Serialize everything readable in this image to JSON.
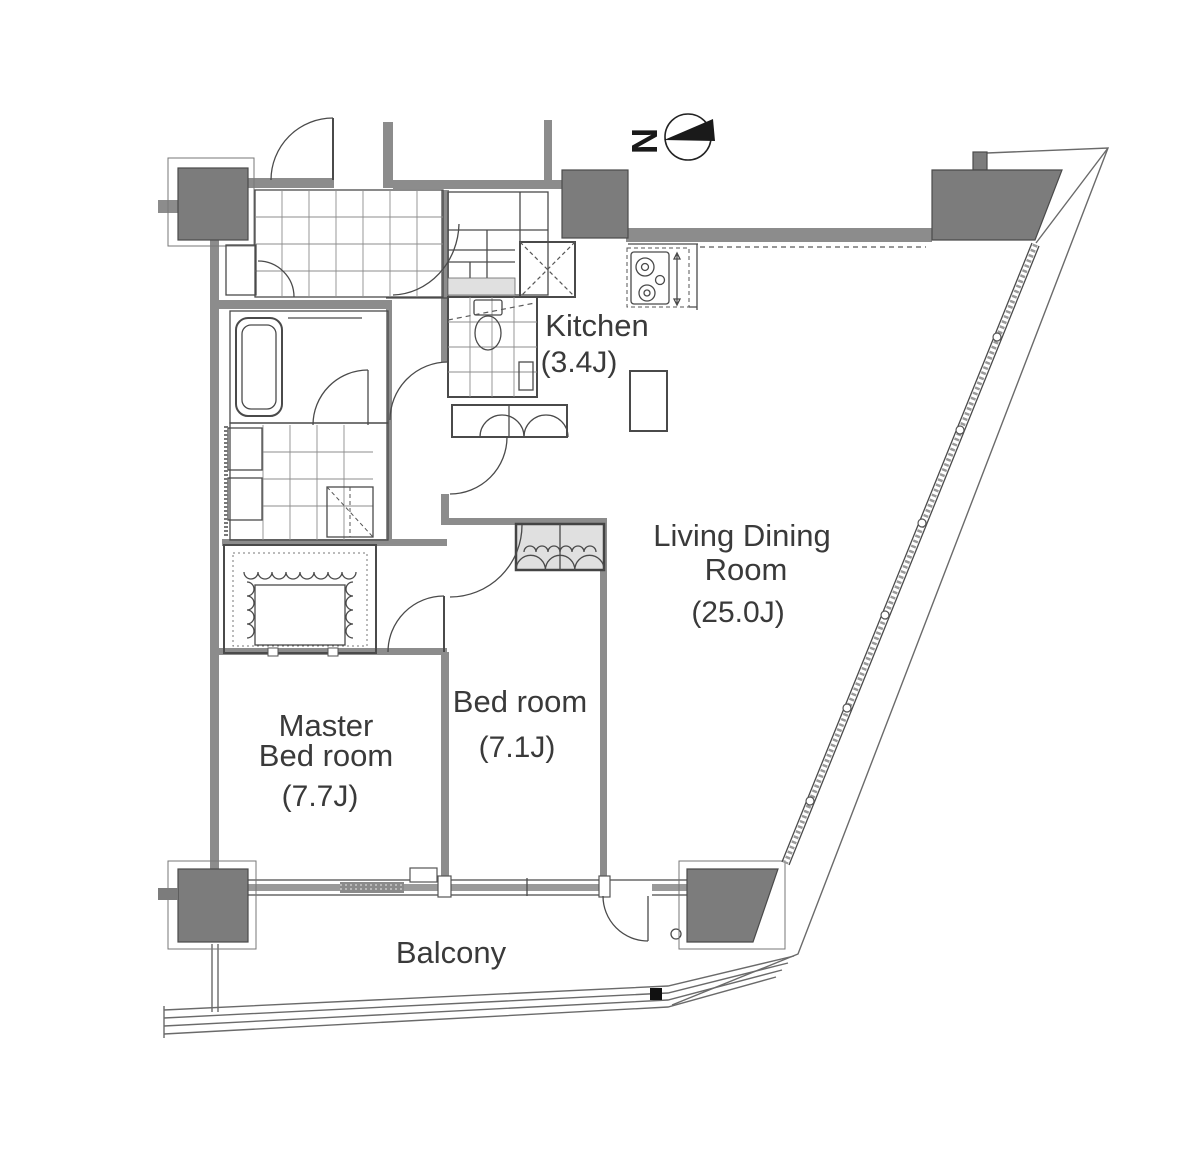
{
  "compass": {
    "label": "N"
  },
  "rooms": {
    "kitchen": {
      "name": "Kitchen",
      "size": "(3.4J)"
    },
    "living_dining": {
      "name_line1": "Living Dining",
      "name_line2": "Room",
      "size": "(25.0J)"
    },
    "bedroom": {
      "name": "Bed room",
      "size": "(7.1J)"
    },
    "master_bedroom": {
      "name_line1": "Master",
      "name_line2": "Bed room",
      "size": "(7.7J)"
    },
    "balcony": {
      "name": "Balcony"
    }
  },
  "colors": {
    "wall": "#8c8c8c",
    "column": "#7c7c7c",
    "fixture_fill": "#ebebeb",
    "closet_fill": "#e0e0e0",
    "line": "#4a4a4a",
    "label_text": "#3a3a3a",
    "background": "#ffffff"
  }
}
